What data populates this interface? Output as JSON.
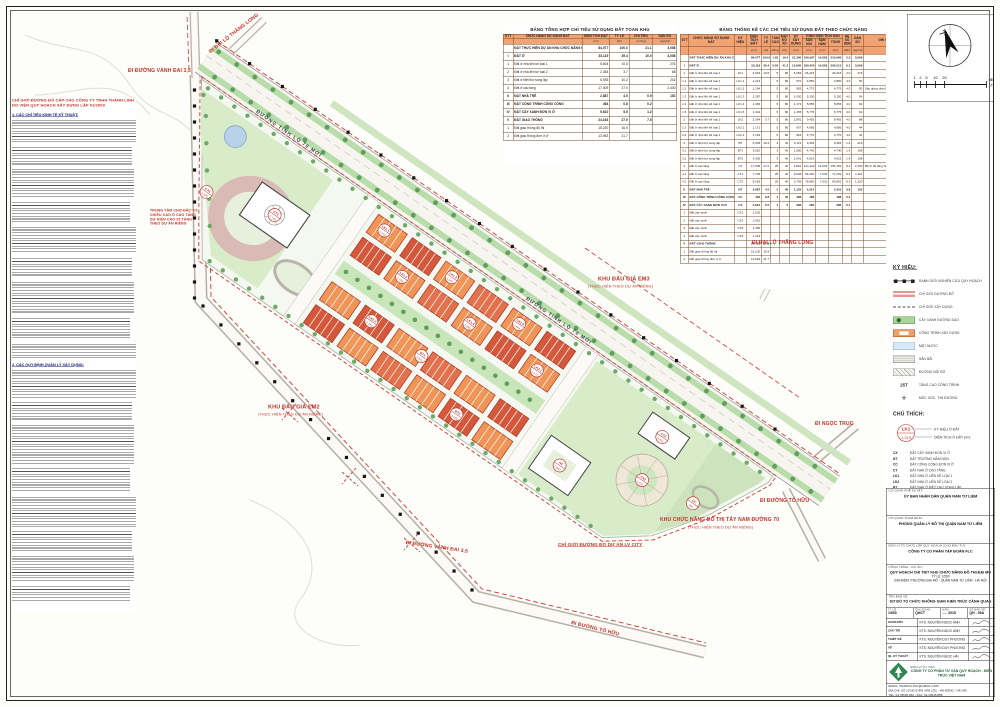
{
  "sheet": {
    "summary_title": "BẢNG TỔNG HỢP CHỈ TIÊU SỬ DỤNG ĐẤT TOÀN KHU",
    "stats_title": "BẢNG THỐNG KÊ CÁC CHỈ TIÊU SỬ DỤNG ĐẤT THEO CHỨC NĂNG"
  },
  "summary_table": {
    "columns": [
      "STT",
      "CHỨC NĂNG SỬ DỤNG ĐẤT",
      "DIỆN TÍCH ĐẤT",
      "TỶ LỆ",
      "CHỈ TIÊU",
      "DÂN SỐ"
    ],
    "units": [
      "",
      "",
      "(m²)",
      "(%)",
      "(m²/ng)",
      "(người)"
    ],
    "rows": [
      {
        "c": [
          "",
          "ĐẤT THỰC HIỆN DỰ ÁN KHU CHỨC NĂNG ĐÔ THỊ ĐẠI MỖ",
          "84,077",
          "100.0",
          "21.1",
          "3,008"
        ],
        "b": 1
      },
      {
        "c": [
          "I",
          "ĐẤT Ở",
          "33,119",
          "39.4",
          "10.0",
          "3,008"
        ],
        "b": 1
      },
      {
        "c": [
          "1",
          "Đất ở nhà liền kề loại 1",
          "6,604",
          "10.5",
          "",
          "276"
        ],
        "b": 0
      },
      {
        "c": [
          "2",
          "Đất ở nhà liền kề loại 2",
          "2,364",
          "3.7",
          "",
          "88"
        ],
        "b": 0
      },
      {
        "c": [
          "3",
          "Đất ở biệt thự song lập",
          "6,935",
          "10.2",
          "",
          "216"
        ],
        "b": 0
      },
      {
        "c": [
          "4",
          "Đất ở cao tầng",
          "17,009",
          "27.0",
          "",
          "2,430"
        ],
        "b": 0
      },
      {
        "c": [
          "II",
          "ĐẤT NHÀ TRẺ",
          "2,887",
          "4.5",
          "0.9",
          "152"
        ],
        "b": 1
      },
      {
        "c": [
          "III",
          "ĐẤT CÔNG TRÌNH CÔNG CỘNG",
          "464",
          "0.8",
          "0.2",
          ""
        ],
        "b": 1
      },
      {
        "c": [
          "IV",
          "ĐẤT CÂY XANH ĐƠN VỊ Ở",
          "5,610",
          "5.5",
          "1.2",
          ""
        ],
        "b": 1
      },
      {
        "c": [
          "V",
          "ĐẤT GIAO THÔNG",
          "24,163",
          "27.9",
          "7.5",
          ""
        ],
        "b": 1
      },
      {
        "c": [
          "1",
          "Đất giao thông đô thị",
          "15,220",
          "16.9",
          "",
          ""
        ],
        "b": 0
      },
      {
        "c": [
          "2",
          "Đất giao thông đơn vị ở",
          "13,963",
          "21.7",
          "",
          ""
        ],
        "b": 0
      }
    ]
  },
  "stats_table": {
    "head1": [
      "STT",
      "CHỨC NĂNG SỬ DỤNG ĐẤT",
      "KÝ HIỆU",
      "DIỆN TÍCH ĐẤT",
      "TỶ LỆ",
      "TẦNG CAO",
      "MẬT ĐỘ XD",
      "DT XÂY DỰNG",
      "TỔNG DIỆN TÍCH SÀN",
      "HỆ SỐ SDĐ",
      "DÂN SỐ",
      "GHI CHÚ"
    ],
    "head2": [
      "SÀN NỔI",
      "SÀN HẦM",
      "TỔNG"
    ],
    "units": [
      "",
      "",
      "",
      "(m²)",
      "(%)",
      "(tầng)",
      "(%)",
      "(m²)",
      "(m²)",
      "(m²)",
      "(m²)",
      "(lần)",
      "(người)",
      ""
    ],
    "rows": [
      {
        "c": [
          "",
          "ĐẤT THỰC HIỆN DỰ ÁN KHU CHỨC NĂNG ĐÔ THỊ",
          "",
          "84,077",
          "100.0",
          "1-25",
          "19.4",
          "21,350",
          "196,597",
          "14,063",
          "210,660",
          "2.5",
          "3,008",
          ""
        ],
        "b": 1
      },
      {
        "c": [
          "I",
          "ĐẤT Ở",
          "",
          "33,119",
          "39.4",
          "3-25",
          "41.2",
          "13,650",
          "186,450",
          "14,063",
          "200,513",
          "6.1",
          "3,008",
          ""
        ],
        "b": 1
      },
      {
        "c": [
          "1",
          "Đất ở nhà liền kề loại 1",
          "LK1",
          "6,604",
          "10.5",
          "5",
          "80",
          "5,283",
          "26,415",
          "",
          "26,415",
          "4.0",
          "276",
          ""
        ],
        "b": 0
      },
      {
        "c": [
          "1.1",
          "Đất ở nhà liền kề loại 1",
          "LK1.1",
          "1,213",
          "",
          "5",
          "80",
          "970",
          "4,850",
          "",
          "4,850",
          "4.0",
          "50",
          ""
        ],
        "b": 0
      },
      {
        "c": [
          "1.2",
          "Đất ở nhà liền kề loại 1",
          "LK1.2",
          "1,194",
          "",
          "5",
          "80",
          "955",
          "4,775",
          "",
          "4,775",
          "4.0",
          "50",
          "Xây dựng nhà ở liền kề cao 5 tầng"
        ],
        "b": 0
      },
      {
        "c": [
          "1.3",
          "Đất ở nhà liền kề loại 1",
          "LK1.3",
          "1,287",
          "",
          "5",
          "80",
          "1,030",
          "5,150",
          "",
          "5,150",
          "4.0",
          "54",
          ""
        ],
        "b": 0
      },
      {
        "c": [
          "1.4",
          "Đất ở nhà liền kề loại 1",
          "LK1.4",
          "1,466",
          "",
          "5",
          "80",
          "1,173",
          "5,865",
          "",
          "5,865",
          "4.0",
          "60",
          ""
        ],
        "b": 0
      },
      {
        "c": [
          "1.5",
          "Đất ở nhà liền kề loại 1",
          "LK1.5",
          "1,444",
          "",
          "5",
          "80",
          "1,155",
          "5,775",
          "",
          "5,775",
          "4.0",
          "62",
          ""
        ],
        "b": 0
      },
      {
        "c": [
          "2",
          "Đất ở nhà liền kề loại 2",
          "LK2",
          "2,364",
          "3.7",
          "5",
          "80",
          "1,891",
          "9,455",
          "",
          "9,455",
          "4.0",
          "88",
          ""
        ],
        "b": 0
      },
      {
        "c": [
          "2.1",
          "Đất ở nhà liền kề loại 2",
          "LK2.1",
          "1,171",
          "",
          "5",
          "80",
          "937",
          "4,685",
          "",
          "4,685",
          "4.0",
          "44",
          ""
        ],
        "b": 0
      },
      {
        "c": [
          "2.2",
          "Đất ở nhà liền kề loại 2",
          "LK2.2",
          "1,193",
          "",
          "5",
          "80",
          "954",
          "4,770",
          "",
          "4,770",
          "4.0",
          "44",
          ""
        ],
        "b": 0
      },
      {
        "c": [
          "3",
          "Đất ở biệt thự song lập",
          "BT",
          "6,935",
          "10.2",
          "3",
          "45",
          "3,121",
          "9,363",
          "",
          "9,363",
          "1.4",
          "216",
          ""
        ],
        "b": 0
      },
      {
        "c": [
          "3.1",
          "Đất ở biệt thự song lập",
          "BT1",
          "3,510",
          "",
          "3",
          "45",
          "1,580",
          "4,740",
          "",
          "4,740",
          "1.4",
          "108",
          ""
        ],
        "b": 0
      },
      {
        "c": [
          "3.2",
          "Đất ở biệt thự song lập",
          "BT2",
          "3,425",
          "",
          "3",
          "45",
          "1,541",
          "4,623",
          "",
          "4,623",
          "1.4",
          "108",
          ""
        ],
        "b": 0
      },
      {
        "c": [
          "4",
          "Đất ở cao tầng",
          "CT",
          "17,009",
          "27.0",
          "25",
          "40",
          "6,804",
          "141,120",
          "14,063",
          "155,183",
          "8.3",
          "2,430",
          "Bố trí 02 tầng hầm đỗ xe"
        ],
        "b": 0
      },
      {
        "c": [
          "4.1",
          "Đất ở cao tầng",
          "CT1",
          "7,746",
          "",
          "25",
          "40",
          "3,098",
          "64,260",
          "7,032",
          "71,292",
          "8.3",
          "1,110",
          ""
        ],
        "b": 0
      },
      {
        "c": [
          "4.2",
          "Đất ở cao tầng",
          "CT2",
          "9,263",
          "",
          "25",
          "40",
          "3,706",
          "76,860",
          "7,031",
          "83,891",
          "8.3",
          "1,320",
          ""
        ],
        "b": 0
      },
      {
        "c": [
          "II",
          "ĐẤT NHÀ TRẺ",
          "NT",
          "2,887",
          "4.5",
          "2",
          "40",
          "1,155",
          "2,310",
          "",
          "2,310",
          "0.8",
          "152",
          ""
        ],
        "b": 1
      },
      {
        "c": [
          "III",
          "ĐẤT CÔNG TRÌNH CÔNG CỘNG",
          "CC",
          "464",
          "0.8",
          "1",
          "40",
          "186",
          "186",
          "",
          "186",
          "0.4",
          "",
          ""
        ],
        "b": 1
      },
      {
        "c": [
          "IV",
          "ĐẤT CÂY XANH ĐƠN VỊ Ở",
          "CX",
          "5,610",
          "5.5",
          "1",
          "5",
          "280",
          "280",
          "",
          "280",
          "0.1",
          "",
          ""
        ],
        "b": 1
      },
      {
        "c": [
          "1",
          "Đất cây xanh",
          "CX1",
          "1,525",
          "",
          "",
          "",
          "",
          "",
          "",
          "",
          "",
          "",
          ""
        ],
        "b": 0
      },
      {
        "c": [
          "2",
          "Đất cây xanh",
          "CX2",
          "1,410",
          "",
          "",
          "",
          "",
          "",
          "",
          "",
          "",
          "",
          ""
        ],
        "b": 0
      },
      {
        "c": [
          "3",
          "Đất cây xanh",
          "CX3",
          "1,356",
          "",
          "",
          "",
          "",
          "",
          "",
          "",
          "",
          "",
          ""
        ],
        "b": 0
      },
      {
        "c": [
          "4",
          "Đất cây xanh",
          "CX4",
          "1,319",
          "",
          "",
          "",
          "",
          "",
          "",
          "",
          "",
          "",
          ""
        ],
        "b": 0
      },
      {
        "c": [
          "V",
          "ĐẤT GIAO THÔNG",
          "",
          "24,163",
          "27.9",
          "",
          "",
          "",
          "",
          "",
          "",
          "",
          "",
          ""
        ],
        "b": 1
      },
      {
        "c": [
          "1",
          "Đất giao thông đô thị",
          "",
          "15,220",
          "16.9",
          "",
          "",
          "",
          "",
          "",
          "",
          "",
          "",
          ""
        ],
        "b": 0
      },
      {
        "c": [
          "2",
          "Đất giao thông đơn vị ở",
          "",
          "13,963",
          "21.7",
          "",
          "",
          "",
          "",
          "",
          "",
          "",
          "",
          ""
        ],
        "b": 0
      }
    ]
  },
  "legend": {
    "title": "KÝ HIỆU:",
    "items": [
      {
        "icon": "boundary-marker",
        "label": "RANH GIỚI NGHIÊN CỨU QUY HOẠCH"
      },
      {
        "icon": "red-line",
        "label": "CHỈ GIỚI ĐƯỜNG ĐỎ"
      },
      {
        "icon": "dashed-line",
        "label": "CHỈ GIỚI XÂY DỰNG"
      },
      {
        "icon": "greenery",
        "label": "CÂY XANH ĐƯỜNG DẠO"
      },
      {
        "icon": "building",
        "label": "CÔNG TRÌNH XÂY DỰNG"
      },
      {
        "icon": "water",
        "label": "MẶT NƯỚC"
      },
      {
        "icon": "yard",
        "label": "SÂN BÃI"
      },
      {
        "icon": "path",
        "label": "ĐƯỜNG NỘI BỘ"
      },
      {
        "icon": "height",
        "glyph": "25T",
        "label": "TẦNG CAO CÔNG TRÌNH"
      },
      {
        "icon": "survey-marker",
        "glyph": "✛",
        "label": "MỐC GIỚI, TIM ĐƯỜNG"
      }
    ]
  },
  "annotation_key": {
    "title": "CHÚ THÍCH:",
    "circle_top": "LK1",
    "circle_bottom": "1,213",
    "top_label": "KÝ HIỆU Ô ĐẤT",
    "bottom_label": "DIỆN TÍCH Ô ĐẤT (m²)",
    "codes": [
      [
        "CX",
        "ĐẤT CÂY XANH ĐƠN VỊ Ở"
      ],
      [
        "NT",
        "ĐẤT TRƯỜNG MẦM NON"
      ],
      [
        "CC",
        "ĐẤT CÔNG CỘNG ĐƠN VỊ Ở"
      ],
      [
        "CT",
        "ĐẤT NHÀ Ở CAO TẦNG"
      ],
      [
        "LK1",
        "ĐẤT NHÀ Ở LIỀN KỀ LOẠI 1"
      ],
      [
        "LK2",
        "ĐẤT NHÀ Ở LIỀN KỀ LOẠI 2"
      ],
      [
        "BT",
        "ĐẤT NHÀ Ở BIỆT THỰ SONG LẬP"
      ]
    ]
  },
  "map_labels": {
    "thang_long_nw": "ĐI ĐẠI LỘ THĂNG LONG",
    "vanh_dai_nw": "ĐI ĐƯỜNG VÀNH ĐAI 3,5",
    "tl70_a": "ĐƯỜNG TỈNH LỘ 70 MỚI",
    "tl70_b": "ĐƯỜNG TỈNH LỘ 70 MỚI",
    "thang_long_e": "ĐI ĐẠI LỘ THĂNG LONG",
    "em3": "KHU ĐẤU GIÁ EM3",
    "em3_sub": "(THỰC HIỆN THEO DỰ ÁN RIÊNG)",
    "em2": "KHU ĐẤU GIÁ EM2",
    "em2_sub": "(THỰC HIỆN THEO DỰ ÁN RIÊNG)",
    "ngoc_truc": "ĐI NGỌC TRỤC",
    "to_huu_e": "ĐI ĐƯỜNG TỐ HỮU",
    "tay_nam": "KHU CHỨC NĂNG ĐÔ THỊ TÂY NAM ĐƯỜNG 70",
    "tay_nam_sub": "(THỰC HIỆN THEO DỰ ÁN RIÊNG)",
    "lv_city": "CHỈ GIỚI ĐƯỜNG ĐỎ DỰ ÁN LV CITY",
    "vanh_dai_s": "ĐI ĐƯỜNG VÀNH ĐAI 3,5",
    "to_huu_s": "ĐI ĐƯỜNG TỐ HỮU",
    "note_block": [
      "TRUNG TÂM CHỢ ĐẦU TƯ",
      "CHIỀU CAO Ô CAO TẦNG",
      "DỰ KIẾN CAO 25 TẦNG",
      "THEO DỰ ÁN RIÊNG"
    ]
  },
  "map_lots": [
    {
      "code": "CX1",
      "area": "1,525"
    },
    {
      "code": "CT1",
      "area": "7,746"
    },
    {
      "code": "LK1.1",
      "area": "1,213"
    },
    {
      "code": "LK1.2",
      "area": "1,194"
    },
    {
      "code": "LK1.3",
      "area": "1,287"
    },
    {
      "code": "LK1.4",
      "area": "1,466"
    },
    {
      "code": "LK1.5",
      "area": "1,444"
    },
    {
      "code": "LK2.1",
      "area": "1,171"
    },
    {
      "code": "LK2.2",
      "area": "1,193"
    },
    {
      "code": "BT1",
      "area": "3,510"
    },
    {
      "code": "BT2",
      "area": "3,425"
    },
    {
      "code": "NT",
      "area": "2,887"
    },
    {
      "code": "CT2",
      "area": "9,263"
    },
    {
      "code": "CX2",
      "area": "1,410"
    },
    {
      "code": "CC",
      "area": "464"
    }
  ],
  "notes_panel": {
    "red_line1": "CHỈ GIỚI ĐƯỜNG ĐỎ CẤP CHO CÔNG TY TNHH THÀNH LINH",
    "red_line2": "DO VIỆN QUY HOẠCH XÂY DỰNG LẬP 01/2009",
    "heading1": "1. CÁC CHỈ TIÊU KINH TẾ KỸ THUẬT:",
    "heading2": "2. CÁC QUY ĐỊNH QUẢN LÝ XÂY DỰNG:"
  },
  "compass": {
    "scale_ticks": [
      "1",
      "2",
      "5",
      "10",
      "20"
    ],
    "scale_end_top": "50M",
    "scale_end_bottom": "1/500"
  },
  "titleblock": {
    "approve_caption": "CƠ QUAN PHÊ DUYỆT:",
    "approve_name": "ỦY BAN NHÂN DÂN QUẬN NAM TỪ LIÊM",
    "appraise_caption": "CƠ QUAN THẨM ĐỊNH:",
    "appraise_name": "PHÒNG QUẢN LÝ ĐÔ THỊ QUẬN NAM TỪ LIÊM",
    "investor_caption": "ĐƠN VỊ TỔ CHỨC LẬP QUY HOẠCH (CHỦ ĐẦU TƯ):",
    "investor_name": "CÔNG TY CỔ PHẦN TẬP ĐOÀN FLC",
    "project_caption": "CÔNG TRÌNH - DỰ ÁN:",
    "project_name": "QUY HOẠCH CHI TIẾT KHU CHỨC NĂNG ĐÔ THỊ ĐẠI MỖ",
    "project_scale": "TỶ LỆ 1/500",
    "project_location": "ĐỊA ĐIỂM: PHƯỜNG ĐẠI MỖ - QUẬN NAM TỪ LIÊM - HÀ NỘI",
    "drawing_caption": "TÊN BẢN VẼ:",
    "drawing_name": "SƠ ĐỒ TỔ CHỨC KHÔNG GIAN KIẾN TRÚC CẢNH QUAN",
    "meta": [
      [
        "TỶ LỆ",
        "1/500"
      ],
      [
        "GIAI ĐOẠN",
        "QHCT"
      ],
      [
        "NĂM",
        "..... 2015"
      ],
      [
        "SỐ BẢN VẼ",
        "QH - 05A"
      ]
    ],
    "signatures": [
      [
        "GIÁM ĐỐC",
        "KTS. NGUYỄN NGỌC ANH"
      ],
      [
        "CHỦ TRÌ",
        "KTS. NGUYỄN NGỌC ANH"
      ],
      [
        "THIẾT KẾ",
        "KTS. NGUYỄN DUY PHƯƠNG"
      ],
      [
        "VẼ",
        "KTS. NGUYỄN DUY PHƯƠNG"
      ],
      [
        "QL KỸ THUẬT",
        "KTS. NGUYỄN NGỌC HẢI"
      ]
    ],
    "consultant_caption": "ĐƠN VỊ TƯ VẤN:",
    "consultant_name": "CÔNG TY CỔ PHẦN TƯ VẤN QUY HOẠCH - KIẾN TRÚC VIỆT NAM",
    "contact": [
      "EMAIL: VNARCH.JSC@GMAIL.COM",
      "ĐỊA CHỈ: SỐ 19 NGUYỄN VĂN LỘC - HÀ ĐÔNG - HÀ NỘI",
      "TEL: 04.33545.666 - FAX: 04.33545.888"
    ]
  }
}
